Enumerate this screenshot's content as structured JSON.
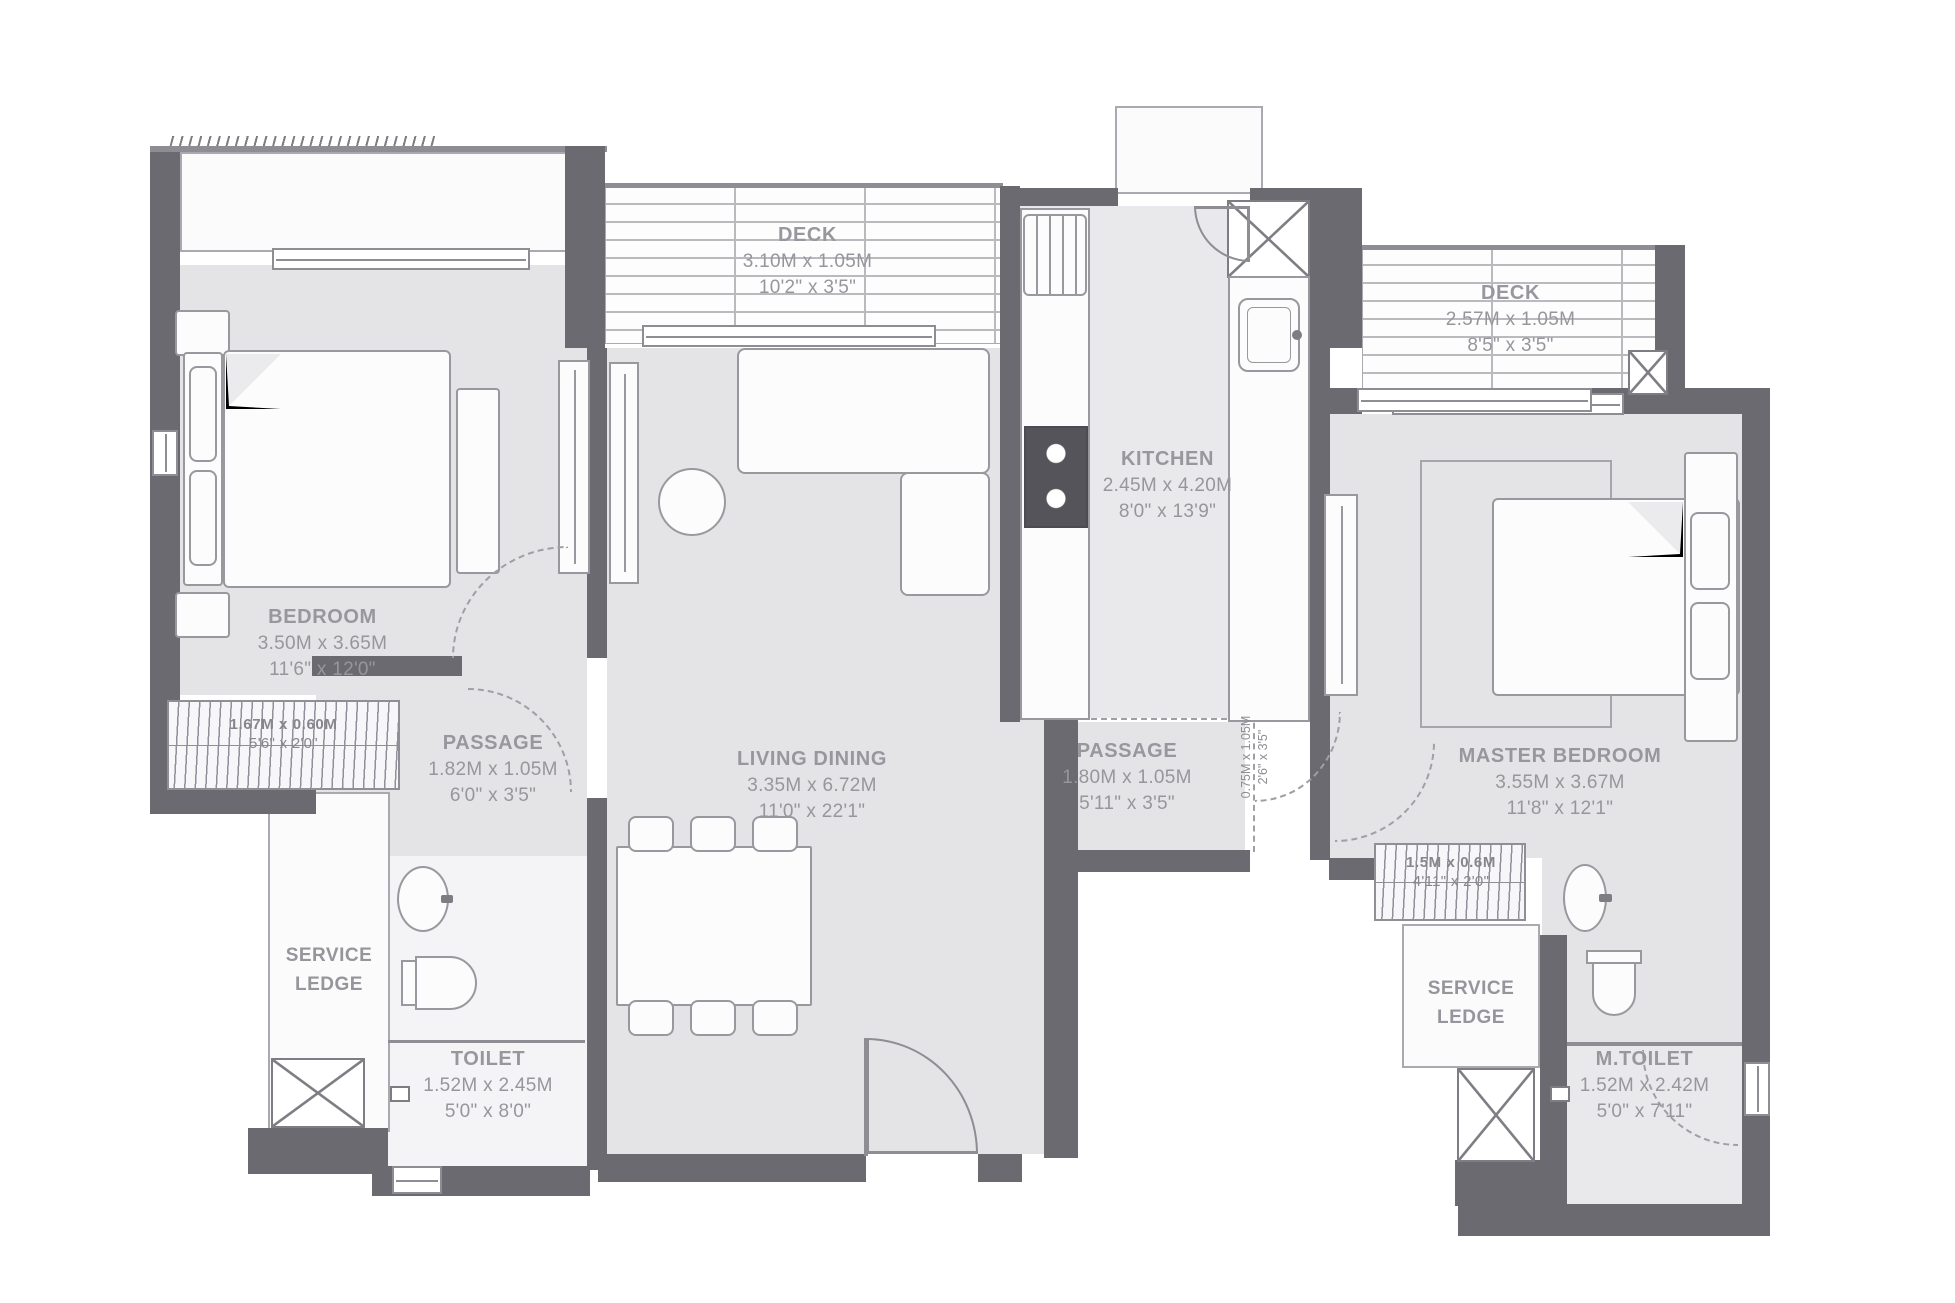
{
  "rooms": {
    "bedroom": {
      "name": "BEDROOM",
      "metric": "3.50M x 3.65M",
      "imperial": "11'6\" x 12'0\""
    },
    "deck1": {
      "name": "DECK",
      "metric": "3.10M x 1.05M",
      "imperial": "10'2\" x 3'5\""
    },
    "living": {
      "name": "LIVING DINING",
      "metric": "3.35M x 6.72M",
      "imperial": "11'0\" x 22'1\""
    },
    "kitchen": {
      "name": "KITCHEN",
      "metric": "2.45M x 4.20M",
      "imperial": "8'0\" x 13'9\""
    },
    "deck2": {
      "name": "DECK",
      "metric": "2.57M x 1.05M",
      "imperial": "8'5\" x 3'5\""
    },
    "master": {
      "name": "MASTER BEDROOM",
      "metric": "3.55M x 3.67M",
      "imperial": "11'8\" x 12'1\""
    },
    "passage_left": {
      "name": "PASSAGE",
      "metric": "1.82M x 1.05M",
      "imperial": "6'0\" x 3'5\""
    },
    "passage_right": {
      "name": "PASSAGE",
      "metric": "1.80M x 1.05M",
      "imperial": "5'11\" x 3'5\""
    },
    "toilet": {
      "name": "TOILET",
      "metric": "1.52M x 2.45M",
      "imperial": "5'0\" x 8'0\""
    },
    "mtoilet": {
      "name": "M.TOILET",
      "metric": "1.52M x 2.42M",
      "imperial": "5'0\" x 7'11\""
    },
    "service_left": {
      "line1": "SERVICE",
      "line2": "LEDGE"
    },
    "service_right": {
      "line1": "SERVICE",
      "line2": "LEDGE"
    },
    "wardrobe_left": {
      "metric": "1.67M x 0.60M",
      "imperial": "5'6\" x 2'0\""
    },
    "wardrobe_right": {
      "metric": "1.5M x 0.6M",
      "imperial": "4'11\" x 2'0\""
    },
    "niche": {
      "metric": "0.75M x 1.05M",
      "imperial": "2'6\" x 3'5\""
    }
  },
  "colors": {
    "wall": "#6b6a71",
    "floor": "#e4e4e6",
    "accent_line": "#8d8d93",
    "text": "#97979d",
    "background": "#ffffff"
  }
}
